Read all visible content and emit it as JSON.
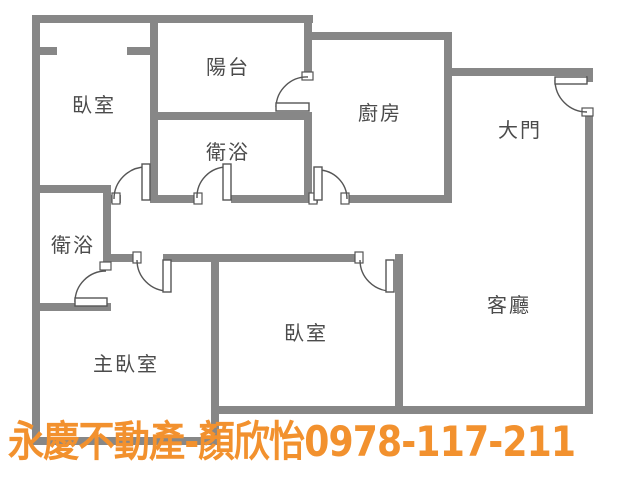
{
  "colors": {
    "wall": "#878787",
    "door_line": "#555555",
    "label_text": "#4b4b4b",
    "watermark": "#F2912E",
    "background": "#ffffff"
  },
  "rooms": [
    {
      "name": "bedroom-top-left",
      "label": "臥室"
    },
    {
      "name": "balcony",
      "label": "陽台"
    },
    {
      "name": "bathroom-upper",
      "label": "衛浴"
    },
    {
      "name": "kitchen",
      "label": "廚房"
    },
    {
      "name": "main-entrance",
      "label": "大門"
    },
    {
      "name": "bathroom-left",
      "label": "衛浴"
    },
    {
      "name": "living-room",
      "label": "客廳"
    },
    {
      "name": "bedroom-middle",
      "label": "臥室"
    },
    {
      "name": "master-bedroom",
      "label": "主臥室"
    }
  ],
  "watermark": {
    "brand": "永慶不動產",
    "agent": "顏欣怡",
    "phone": "0978-117-211",
    "text": "永慶不動產-顏欣怡0978-117-211"
  }
}
